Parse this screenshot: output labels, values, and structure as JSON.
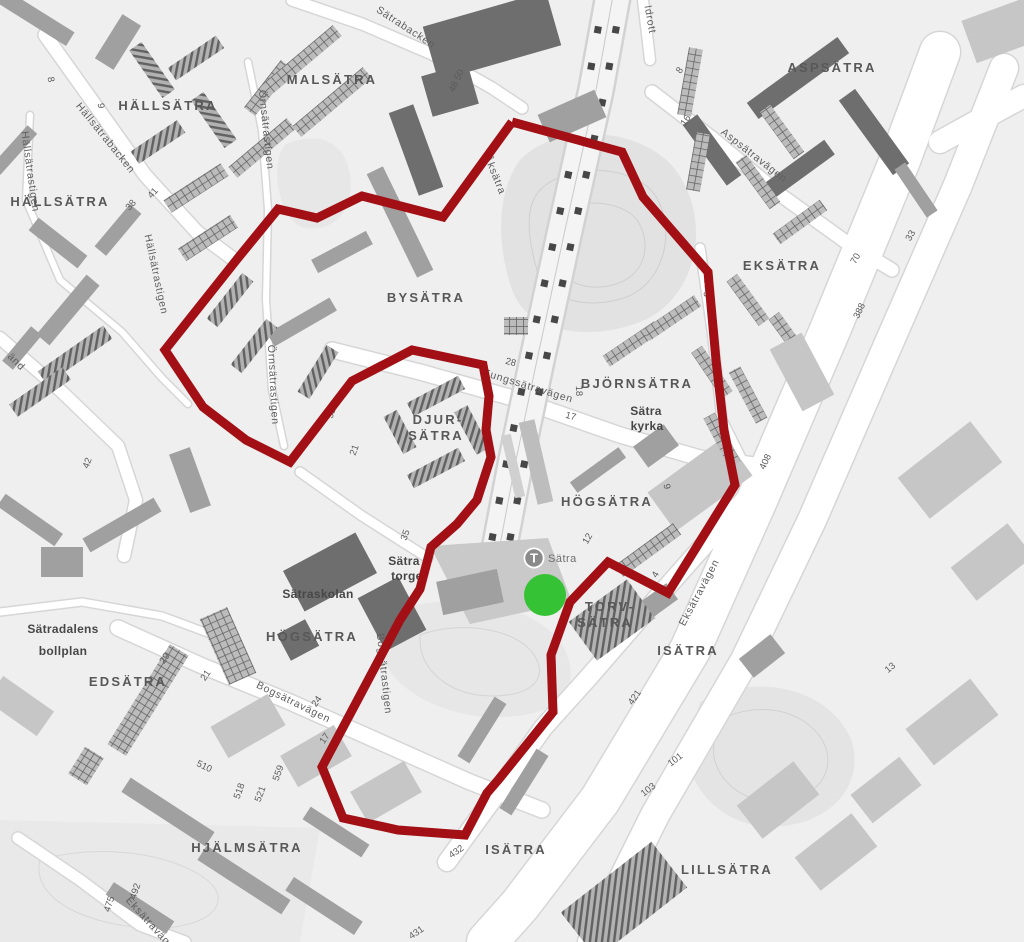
{
  "map": {
    "colors": {
      "background": "#efefef",
      "route": "#a21015",
      "marker_green": "#35c335",
      "road_fill": "#ffffff",
      "road_casing": "#d6d6d6"
    },
    "route_points": [
      [
        512,
        122
      ],
      [
        622,
        152
      ],
      [
        643,
        197
      ],
      [
        676,
        235
      ],
      [
        708,
        272
      ],
      [
        716,
        360
      ],
      [
        724,
        430
      ],
      [
        735,
        485
      ],
      [
        668,
        593
      ],
      [
        608,
        562
      ],
      [
        570,
        602
      ],
      [
        551,
        655
      ],
      [
        553,
        712
      ],
      [
        499,
        779
      ],
      [
        487,
        793
      ],
      [
        465,
        835
      ],
      [
        398,
        830
      ],
      [
        343,
        818
      ],
      [
        322,
        767
      ],
      [
        400,
        620
      ],
      [
        420,
        589
      ],
      [
        431,
        547
      ],
      [
        457,
        524
      ],
      [
        477,
        500
      ],
      [
        491,
        457
      ],
      [
        486,
        430
      ],
      [
        489,
        396
      ],
      [
        483,
        365
      ],
      [
        412,
        350
      ],
      [
        352,
        381
      ],
      [
        290,
        462
      ],
      [
        246,
        440
      ],
      [
        203,
        407
      ],
      [
        165,
        350
      ],
      [
        238,
        258
      ],
      [
        278,
        209
      ],
      [
        317,
        218
      ],
      [
        362,
        196
      ],
      [
        443,
        217
      ],
      [
        512,
        122
      ]
    ],
    "marker": {
      "x": 545,
      "y": 595,
      "r": 21
    },
    "station": {
      "symbol": "T",
      "name": "Sätra",
      "x": 534,
      "y": 558
    },
    "area_labels": [
      {
        "text": "HÄLLSÄTRA",
        "x": 168,
        "y": 110,
        "rot": 0
      },
      {
        "text": "HÄLLSÄTRA",
        "x": 60,
        "y": 206,
        "rot": 0
      },
      {
        "text": "MALSÄTRA",
        "x": 332,
        "y": 84,
        "rot": 0
      },
      {
        "text": "ASPSÄTRA",
        "x": 832,
        "y": 72,
        "rot": 0
      },
      {
        "text": "EKSÄTRA",
        "x": 782,
        "y": 270,
        "rot": 0
      },
      {
        "text": "BYSÄTRA",
        "x": 426,
        "y": 302,
        "rot": 0
      },
      {
        "text": "BJÖRNSÄTRA",
        "x": 637,
        "y": 388,
        "rot": 0
      },
      {
        "text": "DJUR-",
        "x": 438,
        "y": 424,
        "rot": 0
      },
      {
        "text": "SÄTRA",
        "x": 436,
        "y": 440,
        "rot": 0
      },
      {
        "text": "HÖGSÄTRA",
        "x": 607,
        "y": 506,
        "rot": 0
      },
      {
        "text": "TORV-",
        "x": 610,
        "y": 611,
        "rot": 0
      },
      {
        "text": "SÄTRA",
        "x": 605,
        "y": 627,
        "rot": 0
      },
      {
        "text": "ISÄTRA",
        "x": 688,
        "y": 655,
        "rot": 0
      },
      {
        "text": "HÖGSÄTRA",
        "x": 312,
        "y": 641,
        "rot": 0
      },
      {
        "text": "EDSÄTRA",
        "x": 128,
        "y": 686,
        "rot": 0
      },
      {
        "text": "HJÄLMSÄTRA",
        "x": 247,
        "y": 852,
        "rot": 0
      },
      {
        "text": "ISÄTRA",
        "x": 516,
        "y": 854,
        "rot": 0
      },
      {
        "text": "LILLSÄTRA",
        "x": 727,
        "y": 874,
        "rot": 0
      }
    ],
    "place_labels": [
      {
        "text": "Sätra",
        "x": 646,
        "y": 415,
        "rot": 0
      },
      {
        "text": "kyrka",
        "x": 647,
        "y": 430,
        "rot": 0
      },
      {
        "text": "Sätraskolan",
        "x": 318,
        "y": 598,
        "rot": 0
      },
      {
        "text": "Sätradalens",
        "x": 63,
        "y": 633,
        "rot": 0
      },
      {
        "text": "bollplan",
        "x": 63,
        "y": 655,
        "rot": 0
      },
      {
        "text": "Sätra",
        "x": 404,
        "y": 565,
        "rot": 0
      },
      {
        "text": "torget",
        "x": 409,
        "y": 580,
        "rot": 0
      }
    ],
    "street_labels": [
      {
        "text": "Hällsätrabacken",
        "x": 103,
        "y": 140,
        "rot": 51
      },
      {
        "text": "Hällsätrastigen",
        "x": 27,
        "y": 172,
        "rot": 82
      },
      {
        "text": "Hällsätrastigen",
        "x": 153,
        "y": 275,
        "rot": 78
      },
      {
        "text": "Örnsätrastigen",
        "x": 263,
        "y": 130,
        "rot": 84
      },
      {
        "text": "Örnsätrastigen",
        "x": 270,
        "y": 385,
        "rot": 87
      },
      {
        "text": "Sätrabacken",
        "x": 404,
        "y": 30,
        "rot": 33
      },
      {
        "text": "Åksätra",
        "x": 492,
        "y": 176,
        "rot": 68
      },
      {
        "text": "Idrott",
        "x": 647,
        "y": 20,
        "rot": 80
      },
      {
        "text": "Aspsätravägen",
        "x": 752,
        "y": 158,
        "rot": 38
      },
      {
        "text": "Kungssätravägen",
        "x": 527,
        "y": 389,
        "rot": 17
      },
      {
        "text": "vägen",
        "x": 706,
        "y": 295,
        "rot": 82
      },
      {
        "text": "Eksätravägen",
        "x": 702,
        "y": 594,
        "rot": -62
      },
      {
        "text": "Eksätravägen",
        "x": 150,
        "y": 928,
        "rot": 48
      },
      {
        "text": "Bogsätravägen",
        "x": 292,
        "y": 705,
        "rot": 26
      },
      {
        "text": "Bogsätrastigen",
        "x": 381,
        "y": 674,
        "rot": 84
      },
      {
        "text": "änd",
        "x": 14,
        "y": 364,
        "rot": 45
      }
    ],
    "number_labels": [
      {
        "text": "8",
        "x": 48,
        "y": 80,
        "rot": 80
      },
      {
        "text": "9",
        "x": 98,
        "y": 106,
        "rot": 85
      },
      {
        "text": "41",
        "x": 155,
        "y": 195,
        "rot": -48
      },
      {
        "text": "38",
        "x": 133,
        "y": 207,
        "rot": -48
      },
      {
        "text": "48 50",
        "x": 459,
        "y": 82,
        "rot": -65
      },
      {
        "text": "8",
        "x": 682,
        "y": 72,
        "rot": -55
      },
      {
        "text": "16",
        "x": 688,
        "y": 122,
        "rot": -55
      },
      {
        "text": "33",
        "x": 913,
        "y": 237,
        "rot": -60
      },
      {
        "text": "70",
        "x": 858,
        "y": 260,
        "rot": -60
      },
      {
        "text": "388",
        "x": 862,
        "y": 312,
        "rot": -65
      },
      {
        "text": "408",
        "x": 768,
        "y": 463,
        "rot": -65
      },
      {
        "text": "28",
        "x": 510,
        "y": 365,
        "rot": 15
      },
      {
        "text": "17",
        "x": 570,
        "y": 419,
        "rot": 15
      },
      {
        "text": "18",
        "x": 576,
        "y": 391,
        "rot": 88
      },
      {
        "text": "52",
        "x": 334,
        "y": 414,
        "rot": -70
      },
      {
        "text": "21",
        "x": 357,
        "y": 451,
        "rot": -70
      },
      {
        "text": "9",
        "x": 664,
        "y": 487,
        "rot": 80
      },
      {
        "text": "12",
        "x": 590,
        "y": 540,
        "rot": -60
      },
      {
        "text": "4",
        "x": 658,
        "y": 576,
        "rot": -60
      },
      {
        "text": "421",
        "x": 637,
        "y": 699,
        "rot": -55
      },
      {
        "text": "13",
        "x": 892,
        "y": 670,
        "rot": -40
      },
      {
        "text": "35",
        "x": 408,
        "y": 536,
        "rot": -70
      },
      {
        "text": "29",
        "x": 167,
        "y": 660,
        "rot": -55
      },
      {
        "text": "21",
        "x": 208,
        "y": 677,
        "rot": -55
      },
      {
        "text": "24",
        "x": 319,
        "y": 703,
        "rot": -55
      },
      {
        "text": "17",
        "x": 327,
        "y": 740,
        "rot": -55
      },
      {
        "text": "510",
        "x": 203,
        "y": 769,
        "rot": 25
      },
      {
        "text": "518",
        "x": 242,
        "y": 792,
        "rot": -70
      },
      {
        "text": "521",
        "x": 263,
        "y": 795,
        "rot": -70
      },
      {
        "text": "559",
        "x": 281,
        "y": 774,
        "rot": -70
      },
      {
        "text": "492",
        "x": 138,
        "y": 892,
        "rot": -72
      },
      {
        "text": "475",
        "x": 112,
        "y": 905,
        "rot": -72
      },
      {
        "text": "432",
        "x": 458,
        "y": 854,
        "rot": -35
      },
      {
        "text": "431",
        "x": 418,
        "y": 935,
        "rot": -35
      },
      {
        "text": "103",
        "x": 650,
        "y": 792,
        "rot": -38
      },
      {
        "text": "101",
        "x": 677,
        "y": 762,
        "rot": -38
      },
      {
        "text": "42",
        "x": 90,
        "y": 464,
        "rot": -70
      }
    ]
  }
}
